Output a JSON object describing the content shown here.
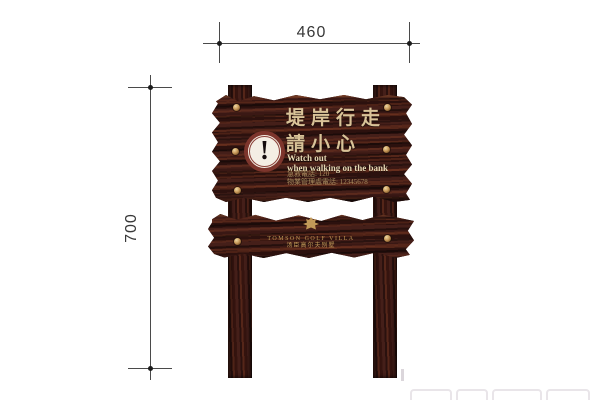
{
  "drawing": {
    "dim_width": "460",
    "dim_height": "700"
  },
  "main_board": {
    "title_line1": "堤岸行走",
    "title_line2": "請小心",
    "subtitle_line1": "Watch out",
    "subtitle_line2": "when walking on the bank",
    "info_line1": "急救電話: 120",
    "info_line2": "物業管理處電話: 12345678",
    "warning_glyph": "!"
  },
  "lower_board": {
    "logo_line1": "TOMSON GOLF VILLA",
    "logo_line2": "汤臣高尔夫别墅"
  },
  "colors": {
    "wood_base": "#401d18",
    "wood_streak_light": "#552619",
    "wood_streak_dark": "#2c110e",
    "rivet_gold": "#c89a5a",
    "title_cream": "#d9c398",
    "info_gold": "#a98e60",
    "logo_gold": "#c29a58",
    "warning_ring": "#7d352c",
    "warning_bg": "#f4eee4",
    "dimension_line": "#4a4a4a"
  }
}
